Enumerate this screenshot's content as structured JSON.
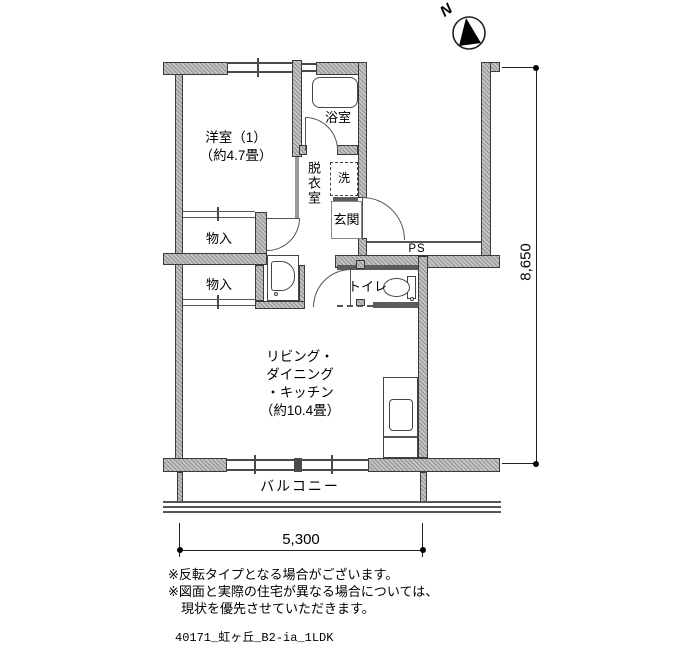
{
  "compass": {
    "label": "N"
  },
  "rooms": {
    "western": {
      "name": "洋室（1）",
      "size": "（約4.7畳）"
    },
    "bath": {
      "name": "浴室"
    },
    "dressing": {
      "name": "脱衣室"
    },
    "laundry": {
      "name": "洗"
    },
    "entrance": {
      "name": "玄関"
    },
    "storage_upper": {
      "name": "物入"
    },
    "storage_lower": {
      "name": "物入"
    },
    "toilet": {
      "name": "トイレ"
    },
    "pipe_space": {
      "name": "PS"
    },
    "ldk": {
      "l1": "リビング・",
      "l2": "ダイニング",
      "l3": "・キッチン",
      "l4": "（約10.4畳）"
    },
    "balcony": {
      "name": "バルコニー"
    }
  },
  "dimensions": {
    "width_mm": "5,300",
    "height_mm": "8,650"
  },
  "notes": {
    "line1": "※反転タイプとなる場合がございます。",
    "line2": "※図面と実際の住宅が異なる場合については、",
    "line3": "現状を優先させていただきます。"
  },
  "file_label": "40171_虹ヶ丘_B2-ia_1LDK"
}
